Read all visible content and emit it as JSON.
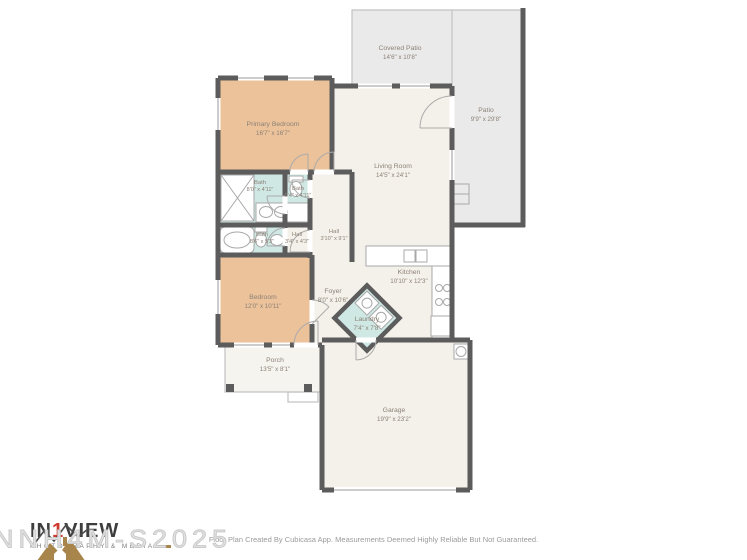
{
  "floor_plan": {
    "rooms": [
      {
        "name": "Covered Patio",
        "dims": "14'6\" x 10'8\""
      },
      {
        "name": "Patio",
        "dims": "9'9\" x 29'8\""
      },
      {
        "name": "Primary Bedroom",
        "dims": "16'7\" x 16'7\""
      },
      {
        "name": "Living Room",
        "dims": "14'5\" x 24'1\""
      },
      {
        "name": "Bath",
        "dims": "8'0\" x 4'11\""
      },
      {
        "name": "Bath",
        "dims": "5'4\" x 4'11\""
      },
      {
        "name": "Bath",
        "dims": "8'6\" x 5'3\""
      },
      {
        "name": "Hall",
        "dims": "3'4\" x 4'3\""
      },
      {
        "name": "Hall",
        "dims": "3'10\" x 9'1\""
      },
      {
        "name": "Bedroom",
        "dims": "12'0\" x 10'11\""
      },
      {
        "name": "Foyer",
        "dims": "8'0\" x 10'6\""
      },
      {
        "name": "Kitchen",
        "dims": "10'10\" x 12'3\""
      },
      {
        "name": "Laundry",
        "dims": "7'4\" x 7'8\""
      },
      {
        "name": "Porch",
        "dims": "13'5\" x 8'1\""
      },
      {
        "name": "Garage",
        "dims": "19'9\" x 23'2\""
      }
    ],
    "colors": {
      "wall": "#5d5c5c",
      "bedroom_fill": "#ecc29a",
      "bath_fill": "#cfe8e4",
      "interior_fill": "#f4f1ea",
      "patio_fill": "#eaeaea",
      "label_text": "#8c8277"
    }
  },
  "watermark": {
    "text": "NNH4M-S2025"
  },
  "logo": {
    "brand_part1": "IN",
    "brand_part2": "1",
    "brand_part3": "VIEW",
    "subtext": "PHOTOGRAPHY & MEDIA",
    "accent_color": "#cf3a30",
    "gold_color": "#a8854a"
  },
  "footer": {
    "disclaimer": "Floor Plan Created By Cubicasa App. Measurements Deemed Highly Reliable But Not Guaranteed."
  }
}
